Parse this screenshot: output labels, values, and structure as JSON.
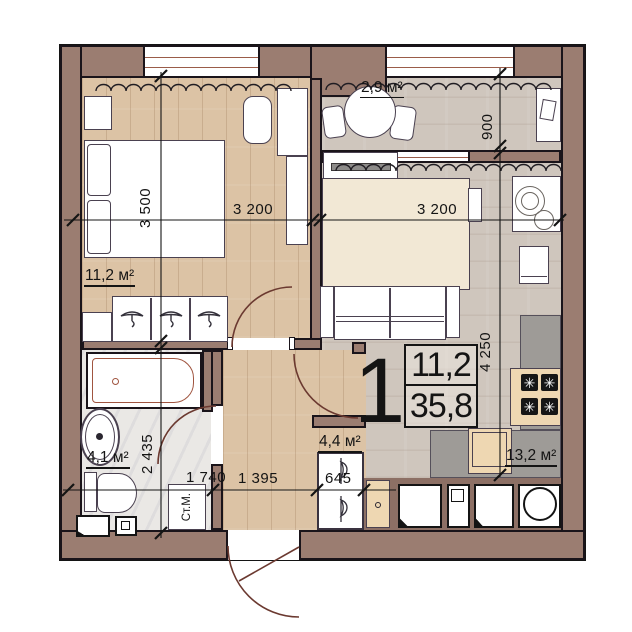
{
  "plan_card": {
    "apartment_number": "1",
    "living_area": "11,2",
    "total_area": "35,8"
  },
  "room_labels": {
    "bedroom": "11,2 м²",
    "balcony": "2,9 м²",
    "kitchen_living": "13,2 м²",
    "bathroom": "4,1 м²",
    "hallway": "4,4 м²"
  },
  "dimensions": {
    "bedroom_width": "3 200",
    "bedroom_depth": "3 500",
    "living_width": "3 200",
    "balcony_depth": "900",
    "kitchen_depth": "4 250",
    "bathroom_depth": "2 435",
    "bathroom_width": "1 740",
    "hallway_width": "1 395",
    "closet_width": "645"
  },
  "labels": {
    "washing_machine": "Ст.М."
  },
  "colors": {
    "wall": "#9b7d71",
    "wood_floor": "#dcc3a5",
    "tile_floor": "#cfc6bd",
    "bath_floor": "#eae8e5",
    "door_arc": "#6b3930",
    "furniture_outline": "#4a4150",
    "counter": "#9e9b97",
    "bed_cover": "#f2e8d5"
  }
}
